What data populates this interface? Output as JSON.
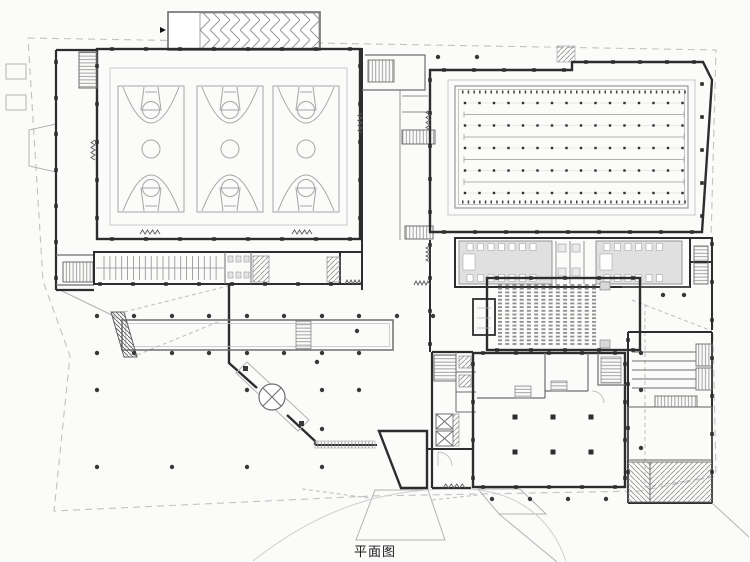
{
  "title": {
    "label": "平面图"
  },
  "colors": {
    "wall": "#2d2d2d",
    "medium": "#6e6e6e",
    "light": "#b3b3b3",
    "court": "#a6a6a6",
    "lane": "#b0b0b0",
    "dot": "#383838",
    "seat": "#8f8f8f",
    "boundary": "#c2c2c2",
    "grayfill": "#e0e0e0",
    "bg": "#fbfbfa"
  },
  "plan": {
    "basketball_hall": {
      "courts_x": [
        118,
        197,
        273
      ],
      "court_y": 86,
      "court_w": 66,
      "court_h": 126,
      "court_count": 3
    },
    "pool": {
      "rim": {
        "x": 455,
        "y": 86,
        "w": 233,
        "h": 122
      },
      "dotted_rows_y": [
        103,
        125.5,
        148,
        170.5,
        193
      ],
      "plain_rows_y": [
        114.5,
        137,
        159.5,
        182
      ],
      "dots_per_row": 16,
      "dot_x0": 465,
      "dot_step": 14.5,
      "line_x0": 464,
      "line_x1": 684,
      "tick_rows_y": [
        92,
        202
      ]
    },
    "auditorium_seats": {
      "x0": 500,
      "x1": 594,
      "cols": 14,
      "y0": 285,
      "y1": 344,
      "rows": 17
    },
    "hall_columns": {
      "xs": [
        515,
        553,
        591
      ],
      "ys": [
        417,
        452
      ],
      "size": 5
    },
    "plaza_dots": [
      {
        "y": 57,
        "xs": [
          438,
          477
        ]
      },
      {
        "y": 295,
        "xs": [
          663,
          684
        ]
      },
      {
        "y": 316,
        "xs": [
          97,
          134,
          172,
          209,
          247,
          284,
          322,
          359,
          397,
          433
        ]
      },
      {
        "y": 331,
        "xs": [
          357
        ]
      },
      {
        "y": 353,
        "xs": [
          97,
          134,
          172,
          209,
          247,
          284,
          322,
          359,
          641
        ]
      },
      {
        "y": 362,
        "xs": [
          317
        ]
      },
      {
        "y": 390,
        "xs": [
          97,
          247,
          322,
          359,
          641
        ]
      },
      {
        "y": 429,
        "xs": [
          322
        ]
      },
      {
        "y": 448,
        "xs": [
          641
        ]
      },
      {
        "y": 467,
        "xs": [
          97,
          172,
          247,
          322
        ]
      },
      {
        "y": 499,
        "xs": [
          492,
          530,
          568,
          606
        ]
      }
    ],
    "wall_ticks": {
      "h": [
        {
          "y": 49,
          "x0": 112,
          "x1": 350,
          "step": 34
        },
        {
          "y": 239,
          "x0": 112,
          "x1": 350,
          "step": 34
        },
        {
          "y": 62,
          "x0": 586,
          "x1": 694,
          "step": 27
        },
        {
          "y": 70,
          "x0": 444,
          "x1": 566,
          "step": 30
        },
        {
          "y": 232,
          "x0": 444,
          "x1": 694,
          "step": 31
        },
        {
          "y": 278,
          "x0": 497,
          "x1": 633,
          "step": 34
        },
        {
          "y": 350,
          "x0": 497,
          "x1": 633,
          "step": 34
        },
        {
          "y": 353,
          "x0": 483,
          "x1": 618,
          "step": 33
        },
        {
          "y": 487,
          "x0": 483,
          "x1": 618,
          "step": 33
        },
        {
          "y": 284,
          "x0": 100,
          "x1": 335,
          "step": 33
        }
      ],
      "v": [
        {
          "x": 56,
          "y0": 62,
          "y1": 282,
          "step": 36
        },
        {
          "x": 97,
          "y0": 66,
          "y1": 226,
          "step": 38
        },
        {
          "x": 360,
          "y0": 66,
          "y1": 226,
          "step": 38
        },
        {
          "x": 430,
          "y0": 80,
          "y1": 344,
          "step": 33
        },
        {
          "x": 702,
          "y0": 84,
          "y1": 224,
          "step": 33
        },
        {
          "x": 712,
          "y0": 244,
          "y1": 496,
          "step": 38
        },
        {
          "x": 473,
          "y0": 364,
          "y1": 478,
          "step": 38
        },
        {
          "x": 625,
          "y0": 364,
          "y1": 478,
          "step": 38
        },
        {
          "x": 628,
          "y0": 340,
          "y1": 474,
          "step": 44
        }
      ]
    },
    "doors": [
      {
        "x": 140,
        "y": 234,
        "len": 20,
        "dir": "h"
      },
      {
        "x": 292,
        "y": 234,
        "len": 20,
        "dir": "h"
      },
      {
        "x": 95,
        "y": 140,
        "len": 20,
        "dir": "v"
      },
      {
        "x": 362,
        "y": 113,
        "len": 20,
        "dir": "v"
      },
      {
        "x": 430,
        "y": 110,
        "len": 20,
        "dir": "v"
      },
      {
        "x": 430,
        "y": 246,
        "len": 16,
        "dir": "v"
      },
      {
        "x": 345,
        "y": 284,
        "len": 16,
        "dir": "h"
      },
      {
        "x": 414,
        "y": 285,
        "len": 16,
        "dir": "h"
      },
      {
        "x": 443,
        "y": 488,
        "len": 22,
        "dir": "h"
      }
    ],
    "locker_bench": {
      "x0": 104,
      "x1": 222,
      "step": 5.9,
      "y0": 256,
      "y1": 280,
      "mid_y": 268
    },
    "changing_rooms": [
      {
        "x": 459,
        "y": 241,
        "w": 93,
        "h": 43
      },
      {
        "x": 596,
        "y": 241,
        "w": 86,
        "h": 43
      }
    ]
  }
}
